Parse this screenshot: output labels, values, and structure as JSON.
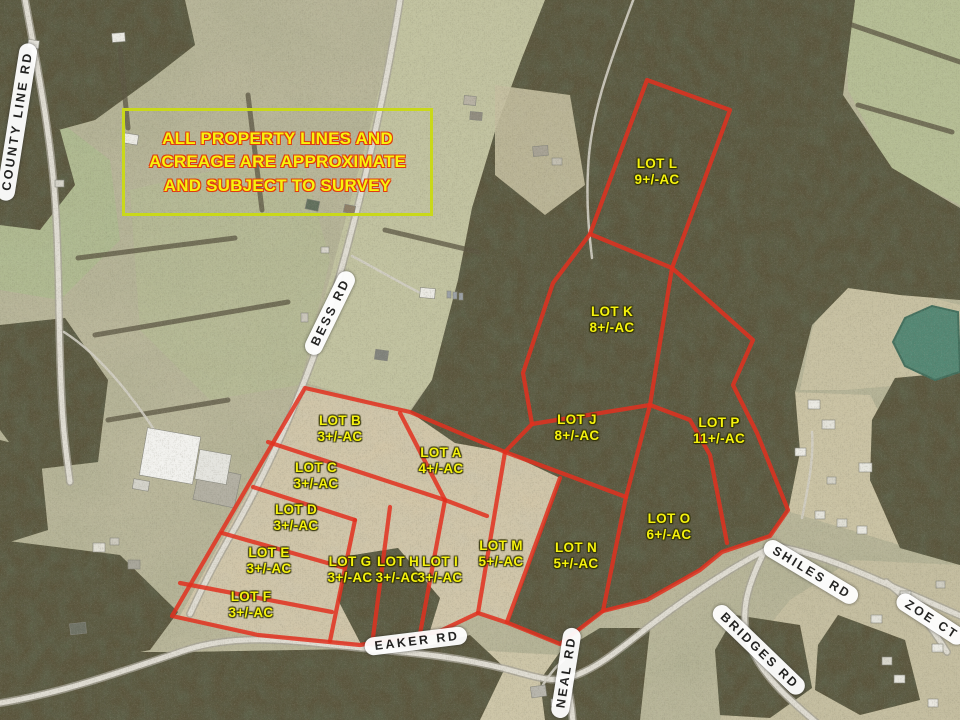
{
  "disclaimer": {
    "lines": [
      "ALL PROPERTY LINES AND",
      "ACREAGE ARE APPROXIMATE",
      "AND SUBJECT TO SURVEY"
    ]
  },
  "lots": [
    {
      "name": "LOT L",
      "acres": "9+/-AC"
    },
    {
      "name": "LOT K",
      "acres": "8+/-AC"
    },
    {
      "name": "LOT J",
      "acres": "8+/-AC"
    },
    {
      "name": "LOT P",
      "acres": "11+/-AC"
    },
    {
      "name": "LOT B",
      "acres": "3+/-AC"
    },
    {
      "name": "LOT A",
      "acres": "4+/-AC"
    },
    {
      "name": "LOT C",
      "acres": "3+/-AC"
    },
    {
      "name": "LOT D",
      "acres": "3+/-AC"
    },
    {
      "name": "LOT E",
      "acres": "3+/-AC"
    },
    {
      "name": "LOT F",
      "acres": "3+/-AC"
    },
    {
      "name": "LOT G",
      "acres": "3+/-AC"
    },
    {
      "name": "LOT H",
      "acres": "3+/-AC"
    },
    {
      "name": "LOT I",
      "acres": "3+/-AC"
    },
    {
      "name": "LOT M",
      "acres": "5+/-AC"
    },
    {
      "name": "LOT N",
      "acres": "5+/-AC"
    },
    {
      "name": "LOT O",
      "acres": "6+/-AC"
    }
  ],
  "roads": [
    {
      "name": "COUNTY LINE RD"
    },
    {
      "name": "BESS RD"
    },
    {
      "name": "EAKER RD"
    },
    {
      "name": "NEAL RD"
    },
    {
      "name": "SHILES RD"
    },
    {
      "name": "ZOE CT"
    },
    {
      "name": "BRIDGES RD"
    }
  ],
  "colors": {
    "parcel_line": "#e2301f",
    "lot_label_text": "#f5f20e",
    "road_label_bg": "#ffffff",
    "road_label_text": "#1d1d1d",
    "disclaimer_border": "#c9d81a",
    "disclaimer_text": "#f7f30c",
    "disclaimer_text_outline": "#e03c10"
  }
}
